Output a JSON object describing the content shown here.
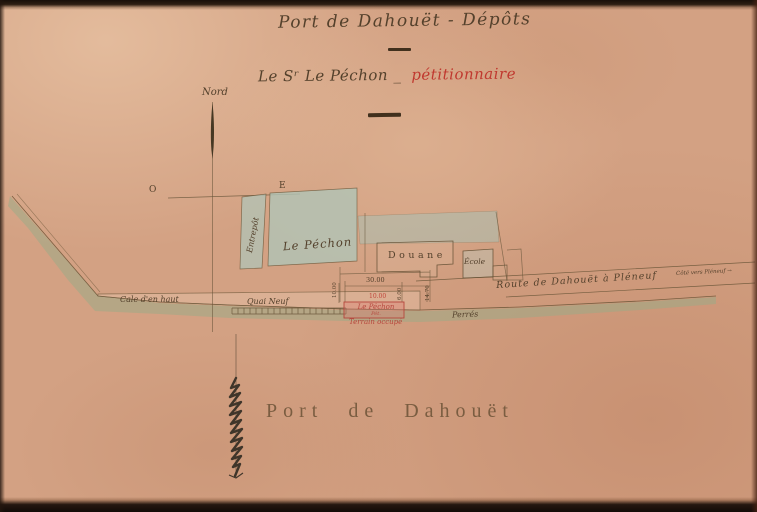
{
  "document": {
    "title": "Port de Dahouët - Dépôts",
    "subtitle_owner": "Le Sʳ Le Péchon _",
    "subtitle_role": "pétitionnaire",
    "map_caption": "Port de Dahouët"
  },
  "compass": {
    "north": "Nord",
    "west": "O",
    "east": "E"
  },
  "parcels": {
    "entrepot": "Entrepôt",
    "le_pechon": "Le Péchon",
    "douane": "Douane",
    "ecole": "École"
  },
  "waterfront": {
    "cale": "Cale d'en haut",
    "quai": "Quai Neuf",
    "perres": "Perrés"
  },
  "petition_plot": {
    "label": "Le Péchon",
    "sublabel": "Pét.",
    "status": "Terrain occupé"
  },
  "road": {
    "name": "Route de Dahouët à Pléneuf",
    "direction": "Côté vers Pléneuf →"
  },
  "dimensions": {
    "front_width": "30.00",
    "plot_width": "10.00",
    "left_depth": "10.00",
    "mid_depth": "6.00",
    "right_depth": "14.70"
  },
  "colors": {
    "paper": "#d3a183",
    "ink": "#54412c",
    "red_ink": "#b5463c",
    "water_wash": "#98ac88",
    "parcel_wash": "#b0c4b7",
    "border": "#170f09"
  }
}
